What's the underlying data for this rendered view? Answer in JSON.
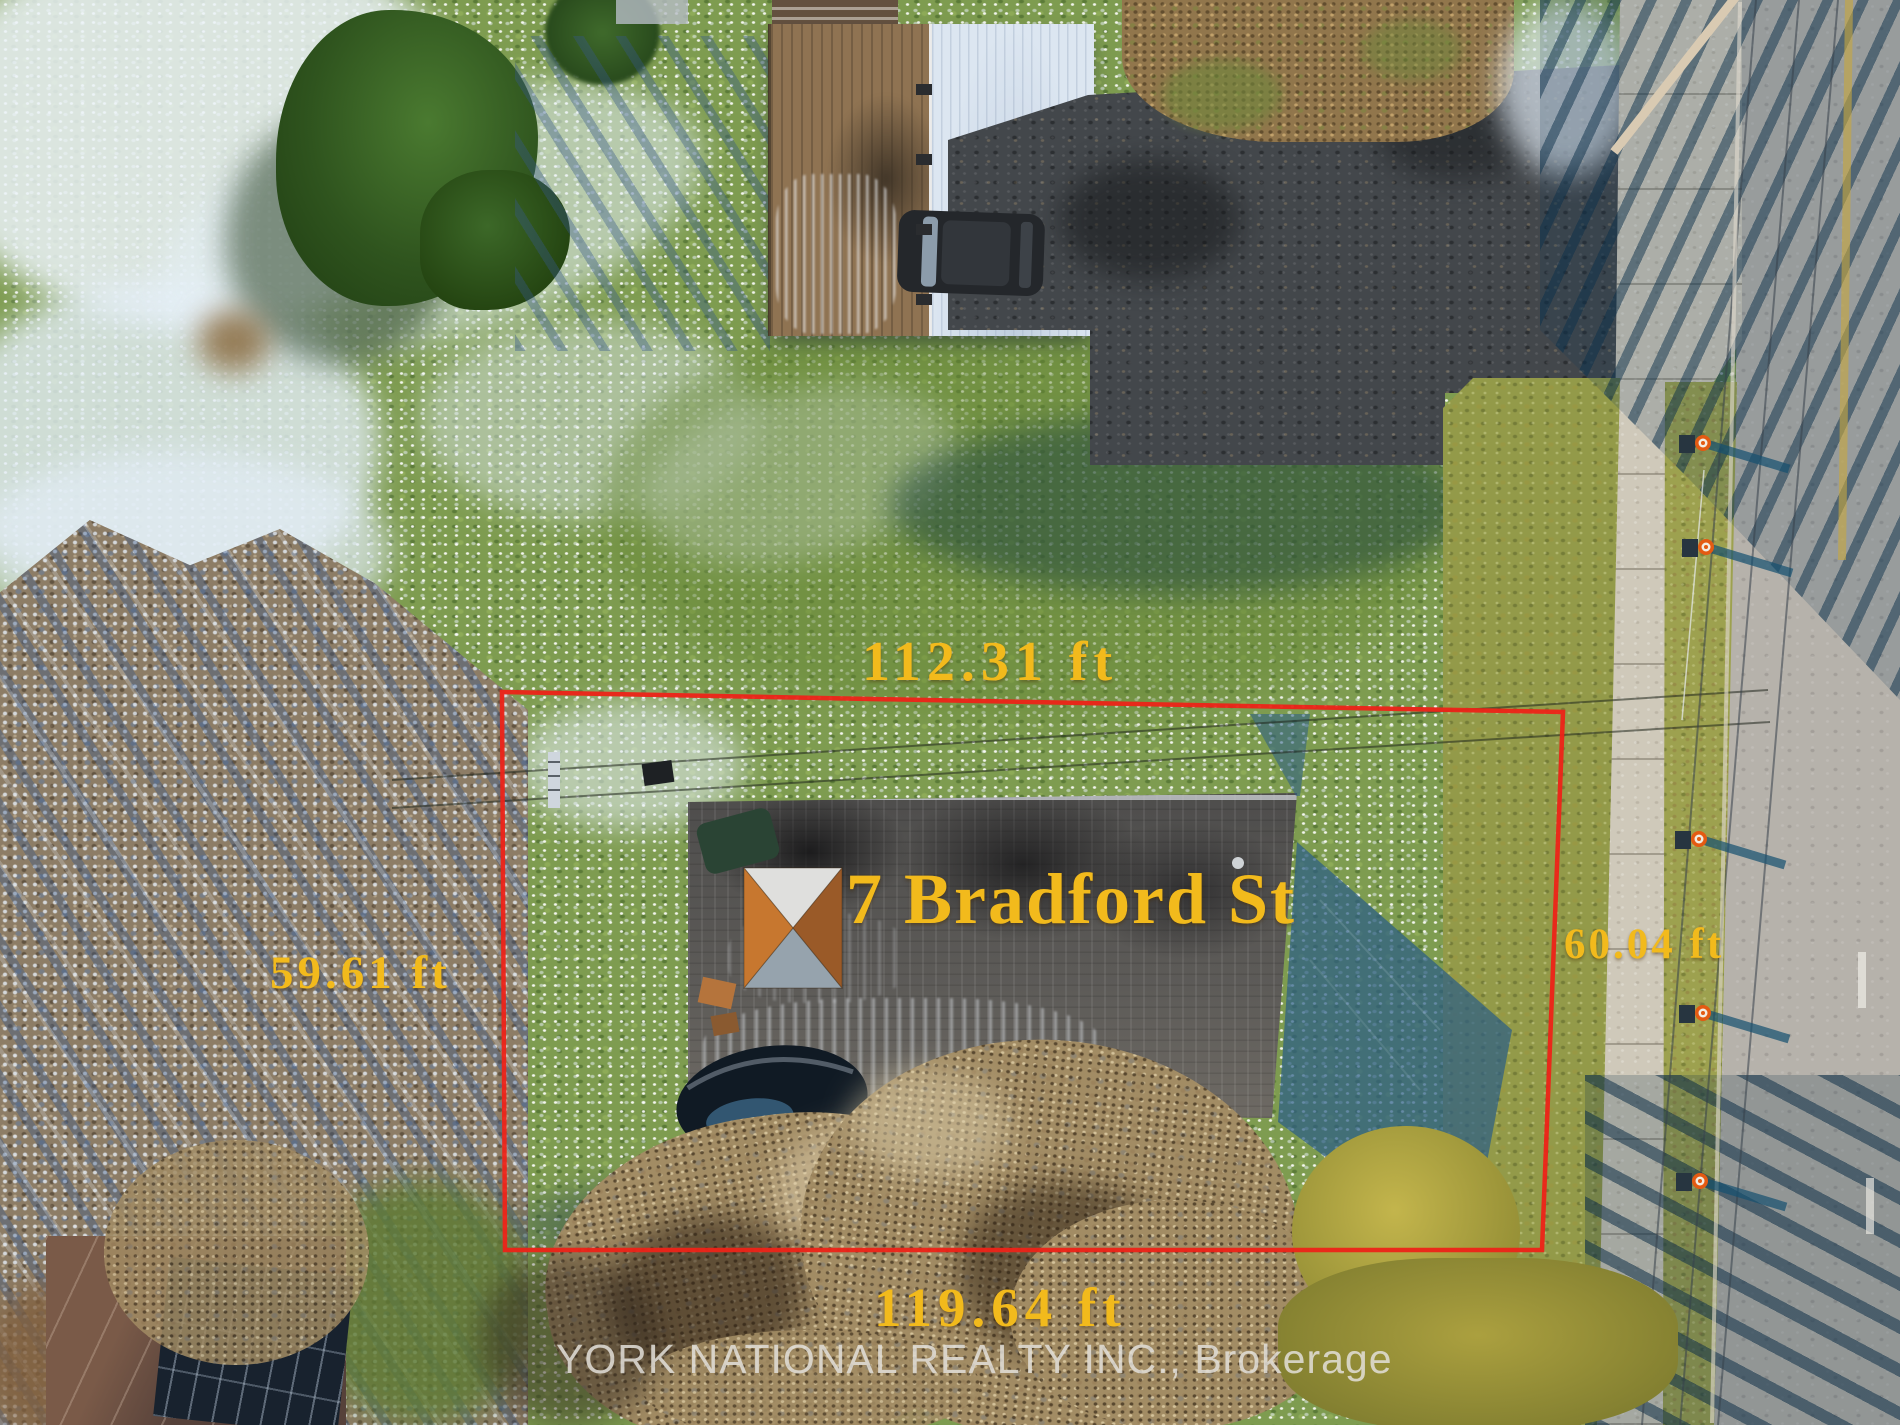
{
  "annotations": {
    "address_label": "7 Bradford St",
    "dim_top": "112.31 ft",
    "dim_left": "59.61 ft",
    "dim_right": "60.04 ft",
    "dim_bottom": "119.64 ft",
    "watermark": "YORK NATIONAL REALTY INC., Brokerage"
  },
  "colors": {
    "boundary_red": "#ed2318",
    "label_yellow": "#f2ba1c",
    "watermark_gray": "#e3e0da"
  }
}
